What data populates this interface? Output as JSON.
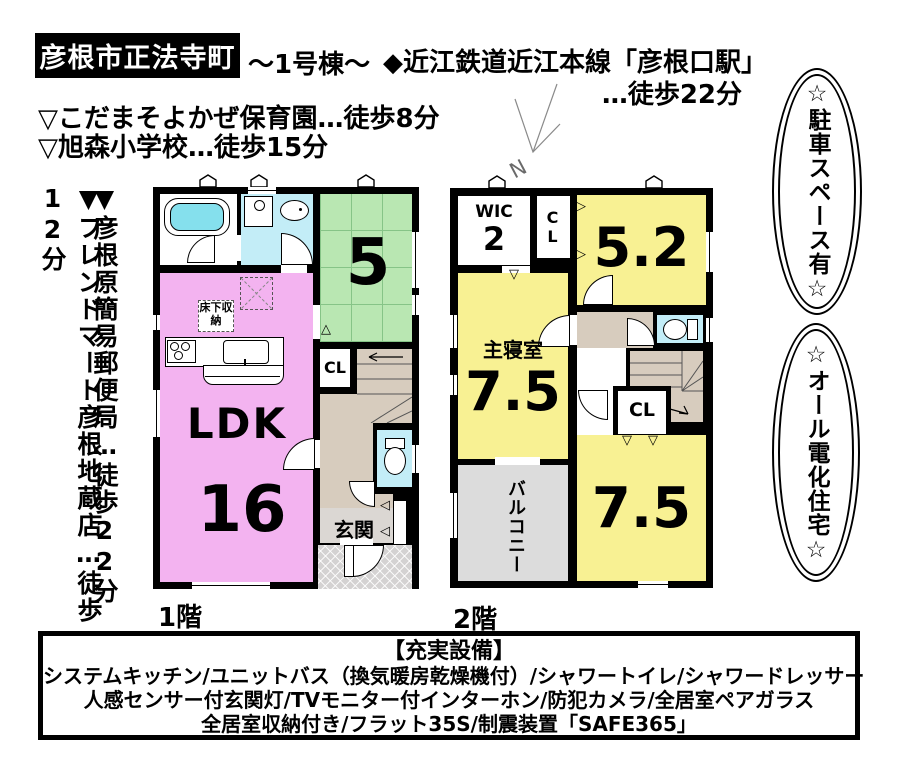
{
  "header": {
    "location": "彦根市正法寺町",
    "building": "～1号棟～",
    "station_line1": "◆近江鉄道近江本線「彦根口駅」",
    "station_line2": "…徒歩22分",
    "access1": "▽こだまそよかぜ保育園…徒歩8分",
    "access2": "▽旭森小学校…徒歩15分"
  },
  "side_notes": {
    "post_office": "▼彦根原簡易郵便局…徒歩22分",
    "supermarket": "▼フレンドマート彦根地蔵店…徒歩12分"
  },
  "badges": {
    "parking": "☆駐車スペース有☆",
    "all_electric": "☆オール電化住宅☆"
  },
  "compass": {
    "north": "N"
  },
  "floor1": {
    "label": "1階",
    "ldk_label": "LDK",
    "ldk_size": "16",
    "tatami_size": "5",
    "closet": "CL",
    "entrance": "玄関",
    "underfloor_storage": "床下収納"
  },
  "floor2": {
    "label": "2階",
    "wic_label": "WIC",
    "wic_size": "2",
    "closet_upper": "CL",
    "closet_lower": "CL",
    "room1_size": "5.2",
    "master_label": "主寝室",
    "master_size": "7.5",
    "room2_size": "7.5",
    "balcony": "バルコニー"
  },
  "equipment": {
    "title": "【充実設備】",
    "line1": "システムキッチン/ユニットバス（換気暖房乾燥機付）/シャワートイレ/シャワードレッサー",
    "line2": "人感センサー付玄関灯/TVモニター付インターホン/防犯カメラ/全居室ペアガラス",
    "line3": "全居室収納付き/フラット35S/制震装置「SAFE365」"
  },
  "colors": {
    "ldk_pink": "#f3b3f0",
    "tatami_green": "#b9e7b2",
    "room_yellow": "#f8f193",
    "wet_cyan": "#c3edf7",
    "water_cyan": "#85e0ed",
    "hall_beige": "#d7ccbe",
    "balcony_gray": "#dcdcdc",
    "porch_gray": "#d4d2d2",
    "genkan_gray": "#dbd7d3",
    "wall_black": "#000000"
  }
}
